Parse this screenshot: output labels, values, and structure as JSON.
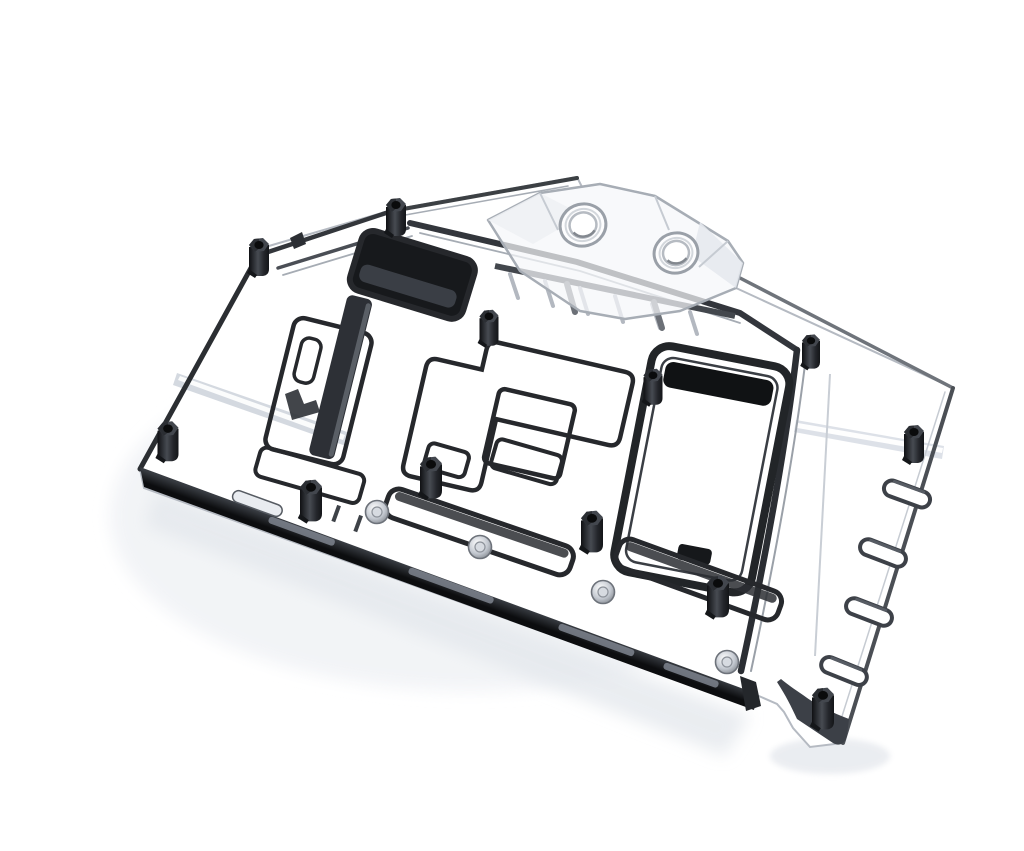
{
  "image": {
    "kind": "product photo render on white background",
    "subject": "Transparent acrylic full-cover GPU water block with black mounting standoffs",
    "aria_label": "Clear acrylic GPU water block shown at an angle: clear terminal with two round ports on the top edge, machined flow-channel outlines over the GPU and VRM areas, a dark metal rail along the bottom edge, oval cutouts on the right wing and twelve black hex standoffs"
  },
  "palette": {
    "background": "#ffffff",
    "acrylic_edge": "#b5bac2",
    "outline_dark": "#26282c",
    "rail_dark": "#17191c",
    "standoff_black": "#1b1d21",
    "highlight_band": "#d3d9e0",
    "screw_silver": "#b9bec6",
    "shadow": "#e9ecf0"
  },
  "parts": {
    "terminal": {
      "name": "inlet-outlet terminal",
      "port_count": 2
    },
    "standoffs": {
      "name": "black hex standoff",
      "count": 12
    },
    "wing_slots": {
      "name": "oval cutout",
      "count": 4
    },
    "silver_screws": {
      "name": "silver coldplate screw",
      "count": 4
    },
    "flow_windows": {
      "name": "dark flow-channel window",
      "count": 2
    },
    "gpu_die": {
      "name": "GPU die square outline",
      "count": 1
    }
  }
}
